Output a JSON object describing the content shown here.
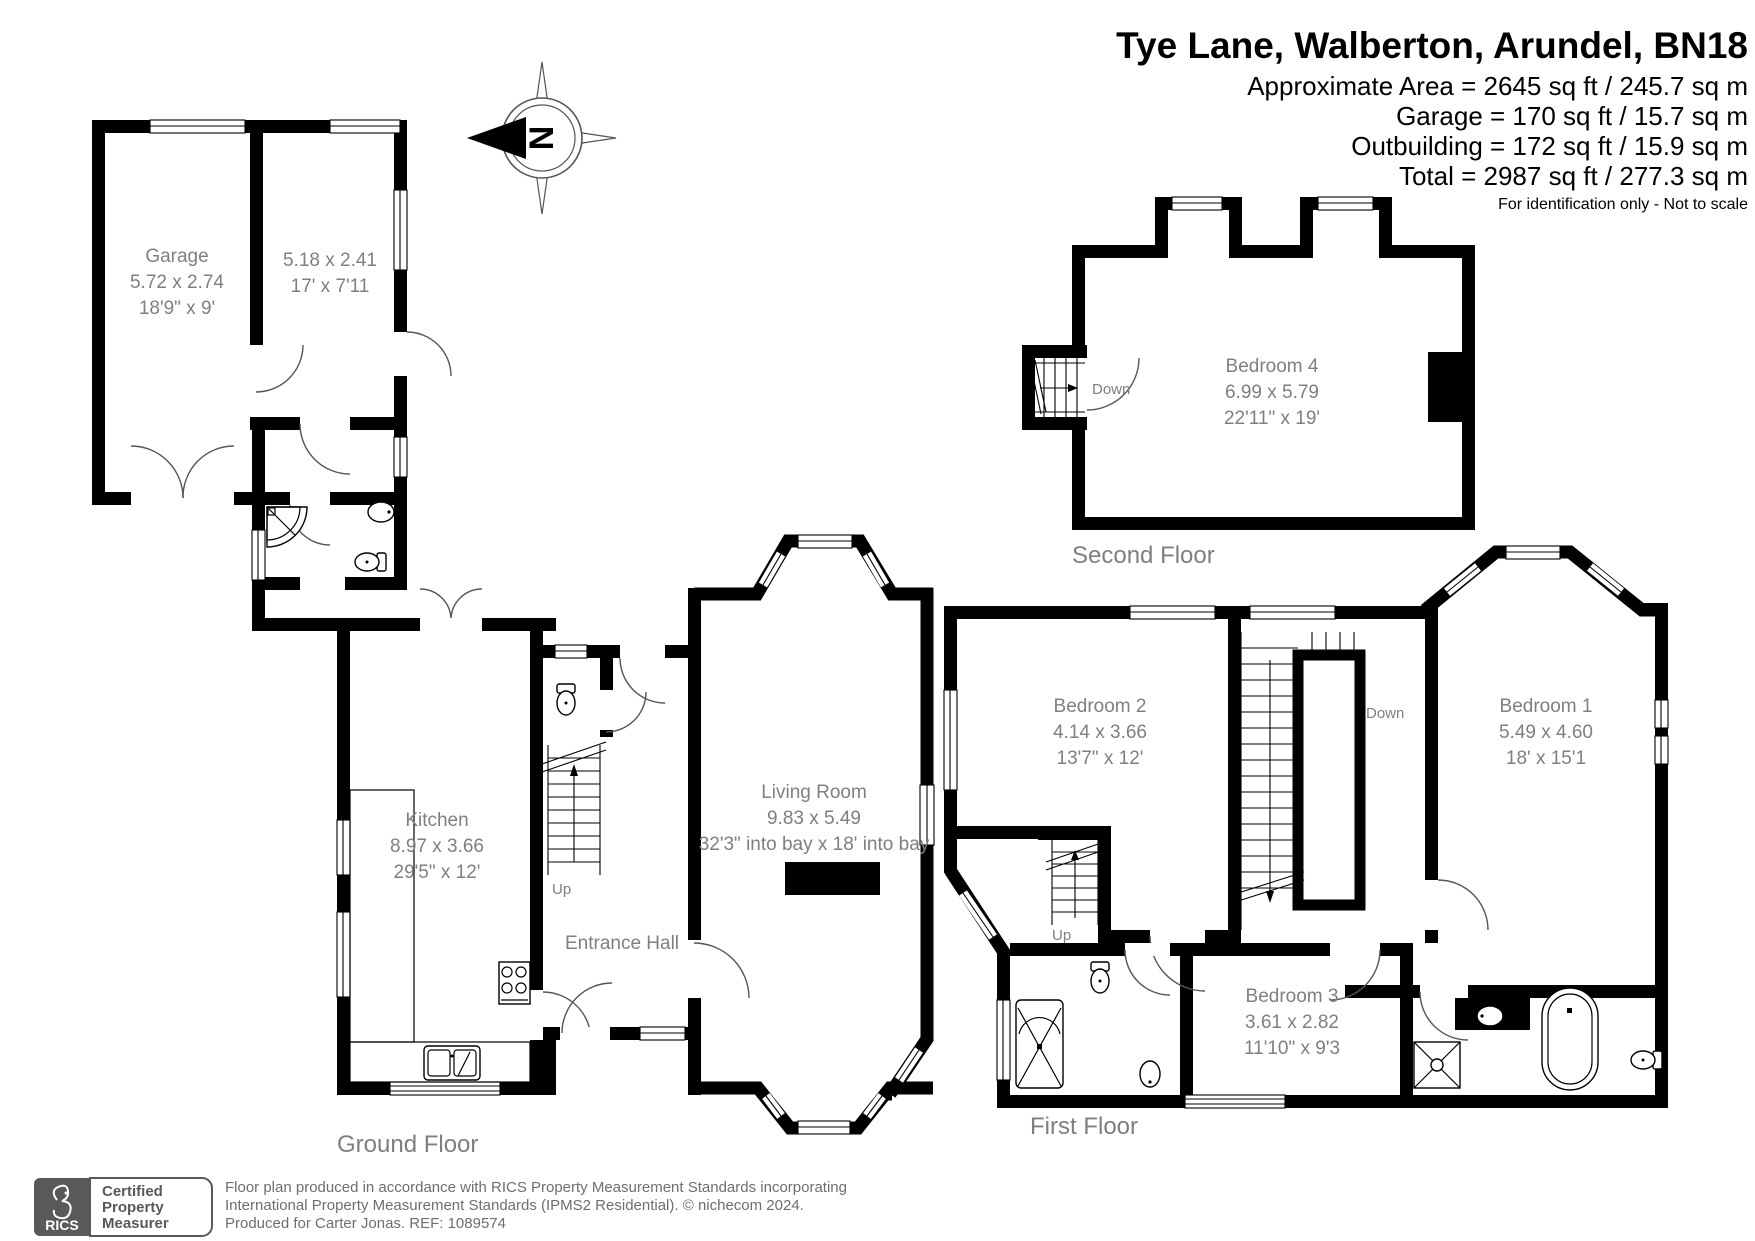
{
  "header": {
    "title": "Tye Lane, Walberton, Arundel, BN18",
    "area_lines": [
      "Approximate Area = 2645 sq ft / 245.7 sq m",
      "Garage = 170 sq ft / 15.7 sq m",
      "Outbuilding = 172 sq ft / 15.9 sq m",
      "Total = 2987 sq ft / 277.3 sq m"
    ],
    "disclaimer": "For identification only - Not to scale"
  },
  "compass": {
    "north_label": "N"
  },
  "floor_labels": {
    "ground": "Ground Floor",
    "first": "First Floor",
    "second": "Second Floor"
  },
  "rooms": {
    "garage": {
      "name": "Garage",
      "metric": "5.72 x 2.74",
      "imperial": "18'9\" x 9'"
    },
    "outbuilding": {
      "metric": "5.18 x 2.41",
      "imperial": "17' x 7'11"
    },
    "kitchen": {
      "name": "Kitchen",
      "metric": "8.97 x 3.66",
      "imperial": "29'5\" x 12'"
    },
    "living": {
      "name": "Living Room",
      "metric": "9.83 x 5.49",
      "imperial": "32'3\" into bay x 18' into bay"
    },
    "entrance": {
      "name": "Entrance Hall"
    },
    "bed1": {
      "name": "Bedroom 1",
      "metric": "5.49 x 4.60",
      "imperial": "18' x 15'1"
    },
    "bed2": {
      "name": "Bedroom 2",
      "metric": "4.14 x 3.66",
      "imperial": "13'7\" x 12'"
    },
    "bed3": {
      "name": "Bedroom 3",
      "metric": "3.61 x 2.82",
      "imperial": "11'10\" x 9'3"
    },
    "bed4": {
      "name": "Bedroom 4",
      "metric": "6.99 x 5.79",
      "imperial": "22'11\" x 19'"
    }
  },
  "stairs": {
    "up": "Up",
    "down": "Down"
  },
  "footer": {
    "rics": "RICS",
    "badge_lines": [
      "Certified",
      "Property",
      "Measurer"
    ],
    "line1": "Floor plan produced in accordance with RICS Property Measurement Standards incorporating",
    "line2": "International Property Measurement Standards (IPMS2 Residential).   © nichecom 2024.",
    "line3": "Produced for Carter Jonas.   REF:  1089574"
  },
  "colors": {
    "wall": "#000000",
    "label_gray": "#7f7f7f",
    "badge_gray": "#58595b"
  }
}
